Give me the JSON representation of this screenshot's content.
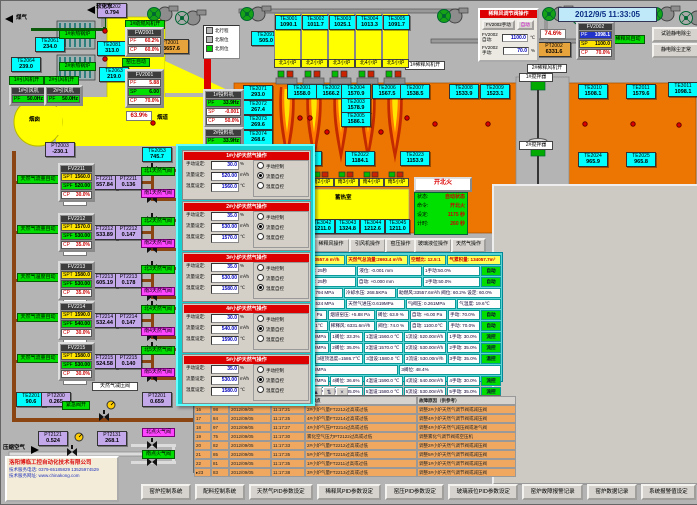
{
  "datetime": "2012/9/5 11:33:05",
  "dilution": {
    "title": "稀释风调节阀操作",
    "manual_btn": "FV2002手动",
    "auto_btn": "自动",
    "auto_label": "FV2002自动:",
    "auto_value": "1100.0",
    "auto_unit": "℃",
    "manual_label": "FV2002手动:",
    "manual_value": "70.0",
    "manual_unit": "%"
  },
  "top_right": {
    "test_btn": "试验静电除尘",
    "ok_btn": "静电除尘正常"
  },
  "fire": {
    "button": "开北火",
    "rows": [
      [
        "状态:",
        "自动状态"
      ],
      [
        "命令:",
        "开北火"
      ],
      [
        "设定:",
        "1175 秒"
      ],
      [
        "计时:",
        "260 秒"
      ]
    ]
  },
  "legend": {
    "items": [
      {
        "sq": "#b8b8b8",
        "t": "北行程"
      },
      {
        "sq": "#b8b8b8",
        "t": "北限位"
      },
      {
        "sq": "#00cc00",
        "t": "北到位"
      }
    ]
  },
  "company": {
    "name": "洛阳博临工控自动化技术有限公司",
    "tel": "技术服务电话: 0379-65185829  13525974529",
    "web": "技术服务网址: www.chinakong.com"
  },
  "regen_north": {
    "room": "蓄热室",
    "cols": [
      [
        "TE3001",
        "1090.1",
        "北1小炉"
      ],
      [
        "TE3002",
        "1011.7",
        "北2小炉"
      ],
      [
        "TE3003",
        "1025.1",
        "北3小炉"
      ],
      [
        "TE3004",
        "1013.3",
        "北4小炉"
      ],
      [
        "TE3005",
        "1091.7",
        "北5小炉"
      ]
    ]
  },
  "regen_south": {
    "room": "蓄热室",
    "cols": [
      [
        "TE3041",
        "1209.6",
        "南1小炉"
      ],
      [
        "TE3042",
        "1211.0",
        "南2小炉"
      ],
      [
        "TE3043",
        "1324.8",
        "南3小炉"
      ],
      [
        "TE3044",
        "1212.6",
        "南4小炉"
      ],
      [
        "TE3045",
        "1211.0",
        "南5小炉"
      ]
    ]
  },
  "op_buttons": [
    {
      "t": "熔化操作",
      "x": 278,
      "w": 30
    },
    {
      "t": "稀释风操作",
      "x": 311,
      "w": 34
    },
    {
      "t": "引风机操作",
      "x": 348,
      "w": 33
    },
    {
      "t": "窑压操作",
      "x": 384,
      "w": 27
    },
    {
      "t": "玻璃液位操作",
      "x": 413,
      "w": 34
    },
    {
      "t": "天然气操作",
      "x": 450,
      "w": 31
    }
  ],
  "controllers": [
    {
      "x": 124,
      "y": 26,
      "w": 33,
      "title": "FW2001",
      "rows": [
        [
          "PF",
          "60.2%",
          "w"
        ],
        [
          "CP",
          "60.0%",
          "r"
        ]
      ]
    },
    {
      "x": 124,
      "y": 68,
      "w": 33,
      "title": "FV2001",
      "rows": [
        [
          "PF",
          "5.88",
          "w"
        ],
        [
          "SP",
          "6.00",
          "g"
        ],
        [
          "CP",
          "70.0%",
          "r"
        ]
      ]
    },
    {
      "x": 202,
      "y": 88,
      "w": 35,
      "title": "1#投料机",
      "rows": [
        [
          "PF",
          "33.9Hz",
          "g"
        ],
        [
          "SP",
          "-0.001",
          "w"
        ],
        [
          "CP",
          "50.0%",
          "r"
        ]
      ]
    },
    {
      "x": 202,
      "y": 126,
      "w": 35,
      "title": "2#投料机",
      "rows": [
        [
          "PF",
          "33.9Hz",
          "g"
        ],
        [
          "SP",
          "-0.001",
          "w"
        ],
        [
          "CP",
          "50.0%",
          "r"
        ]
      ]
    },
    {
      "x": 575,
      "y": 20,
      "w": 33,
      "title": "FV2002",
      "rows": [
        [
          "PF",
          "1098.1",
          "b"
        ],
        [
          "SP",
          "1100.0",
          "y"
        ],
        [
          "CP",
          "70.0%",
          "r"
        ]
      ]
    },
    {
      "x": 8,
      "y": 84,
      "w": 33,
      "title": "1#引风机",
      "rows": [
        [
          "PF",
          "50.0Hz",
          "g"
        ]
      ]
    },
    {
      "x": 43,
      "y": 84,
      "w": 33,
      "title": "2#引风机",
      "rows": [
        [
          "PF",
          "50.0Hz",
          "g"
        ]
      ]
    }
  ],
  "sensors": [
    {
      "id": "PT2202",
      "v": "0.794",
      "x": 96,
      "y": 2,
      "c": "pur"
    },
    {
      "id": "TE2061",
      "v": "234.0",
      "x": 34,
      "y": 36,
      "c": "cyan"
    },
    {
      "id": "TE2064",
      "v": "239.0",
      "x": 10,
      "y": 56,
      "c": "cyan"
    },
    {
      "id": "TE2081",
      "v": "313.0",
      "x": 96,
      "y": 40,
      "c": "cyan"
    },
    {
      "id": "TE2063",
      "v": "219.0",
      "x": 98,
      "y": 66,
      "c": "cyan"
    },
    {
      "id": "PT2003",
      "v": "-230.1",
      "x": 44,
      "y": 141,
      "c": "pur"
    },
    {
      "id": "TE2053",
      "v": "745.7",
      "x": 141,
      "y": 146,
      "c": "cyan"
    },
    {
      "id": "PT2001",
      "v": "33657.6",
      "x": 150,
      "y": 38,
      "c": "org",
      "w": 34
    },
    {
      "id": "PT2002",
      "v": "6331.6",
      "x": 536,
      "y": 41,
      "c": "org",
      "w": 30
    },
    {
      "id": "TE2091",
      "v": "505.0",
      "x": 250,
      "y": 30,
      "c": "cyan"
    },
    {
      "id": "TE2071",
      "v": "293.0",
      "x": 242,
      "y": 84,
      "c": "cyan"
    },
    {
      "id": "TE2072",
      "v": "267.4",
      "x": 242,
      "y": 99,
      "c": "cyan"
    },
    {
      "id": "TE2073",
      "v": "269.6",
      "x": 242,
      "y": 114,
      "c": "cyan"
    },
    {
      "id": "TE2074",
      "v": "268.6",
      "x": 242,
      "y": 129,
      "c": "cyan"
    },
    {
      "id": "TE2075",
      "v": "268.5",
      "x": 242,
      "y": 144,
      "c": "cyan"
    },
    {
      "id": "TE2001",
      "v": "1558.0",
      "x": 286,
      "y": 83,
      "c": "cyan"
    },
    {
      "id": "TE2002",
      "v": "1566.2",
      "x": 315,
      "y": 83,
      "c": "cyan"
    },
    {
      "id": "TE2004",
      "v": "1570.9",
      "x": 340,
      "y": 83,
      "c": "cyan"
    },
    {
      "id": "TE2003",
      "v": "1578.9",
      "x": 340,
      "y": 97,
      "c": "cyan"
    },
    {
      "id": "TE2005",
      "v": "1586.1",
      "x": 340,
      "y": 111,
      "c": "cyan"
    },
    {
      "id": "TE2006",
      "v": "1567.5",
      "x": 371,
      "y": 83,
      "c": "cyan"
    },
    {
      "id": "TE2007",
      "v": "1538.5",
      "x": 399,
      "y": 83,
      "c": "cyan"
    },
    {
      "id": "TE2008",
      "v": "1533.9",
      "x": 448,
      "y": 83,
      "c": "cyan"
    },
    {
      "id": "TE2009",
      "v": "1523.1",
      "x": 479,
      "y": 83,
      "c": "cyan"
    },
    {
      "id": "TE2010",
      "v": "1508.1",
      "x": 577,
      "y": 83,
      "c": "cyan"
    },
    {
      "id": "TE2011",
      "v": "1579.6",
      "x": 625,
      "y": 83,
      "c": "cyan"
    },
    {
      "id": "TE3011",
      "v": "1098.1",
      "x": 667,
      "y": 81,
      "c": "cyan"
    },
    {
      "id": "TE2021",
      "v": "1168.3",
      "x": 291,
      "y": 150,
      "c": "cyan"
    },
    {
      "id": "TE2022",
      "v": "1184.1",
      "x": 344,
      "y": 150,
      "c": "cyan"
    },
    {
      "id": "TE2023",
      "v": "1153.9",
      "x": 399,
      "y": 150,
      "c": "cyan"
    },
    {
      "id": "TE2024",
      "v": "965.9",
      "x": 577,
      "y": 151,
      "c": "cyan"
    },
    {
      "id": "TE2025",
      "v": "965.8",
      "x": 625,
      "y": 151,
      "c": "cyan"
    },
    {
      "id": "TE2201",
      "v": "90.6",
      "x": 15,
      "y": 391,
      "c": "cyan"
    },
    {
      "id": "PT2200",
      "v": "0.265",
      "x": 40,
      "y": 391,
      "c": "pur"
    },
    {
      "id": "PT2201",
      "v": "0.659",
      "x": 141,
      "y": 391,
      "c": "pur"
    },
    {
      "id": "PT2121",
      "v": "0.524",
      "x": 37,
      "y": 430,
      "c": "pur"
    },
    {
      "id": "PT2131",
      "v": "268.1",
      "x": 96,
      "y": 430,
      "c": "pur"
    },
    {
      "id": "PT5001",
      "v": "5.88",
      "x": 495,
      "y": 188,
      "c": "pur"
    },
    {
      "id": "PT5002",
      "v": "6.96",
      "x": 564,
      "y": 188,
      "c": "pur"
    },
    {
      "id": "LT5001",
      "v": "-0.001",
      "x": 625,
      "y": 188,
      "c": "yel"
    }
  ],
  "labels": {
    "green": [
      {
        "t": "1#助燃风机开",
        "x": 124,
        "y": 19,
        "w": 38
      },
      {
        "t": "1#引风机开",
        "x": 8,
        "y": 75,
        "w": 33
      },
      {
        "t": "2#引风机开",
        "x": 43,
        "y": 75,
        "w": 33
      },
      {
        "t": "窑压自动",
        "x": 121,
        "y": 57,
        "w": 26
      },
      {
        "t": "稀释风自动",
        "x": 610,
        "y": 34,
        "w": 32
      },
      {
        "t": "窑压自动",
        "x": 521,
        "y": 190,
        "w": 28
      },
      {
        "t": "玻璃液位自动",
        "x": 652,
        "y": 190,
        "w": 40
      },
      {
        "t": "紧急阀开",
        "x": 61,
        "y": 400,
        "w": 26
      },
      {
        "t": "1#余热锅炉",
        "x": 58,
        "y": 29,
        "w": 35
      },
      {
        "t": "2#余热锅炉",
        "x": 58,
        "y": 61,
        "w": 35
      },
      {
        "t": "南点火气阀",
        "x": 141,
        "y": 449,
        "w": 31
      }
    ],
    "magenta": [
      {
        "t": "北点火气阀",
        "x": 141,
        "y": 427,
        "w": 31
      }
    ],
    "white": [
      {
        "t": "1#稀释风机开",
        "x": 404,
        "y": 60,
        "w": 38
      },
      {
        "t": "2#稀释风机开",
        "x": 526,
        "y": 63,
        "w": 38
      },
      {
        "t": "1#搅拌器",
        "x": 518,
        "y": 72,
        "w": 32
      },
      {
        "t": "2#搅拌器",
        "x": 518,
        "y": 140,
        "w": 32
      },
      {
        "t": "天然气减压阀",
        "x": 91,
        "y": 381,
        "w": 44
      }
    ],
    "red": [
      {
        "t": "助燃风开",
        "x": 203,
        "y": 40,
        "w": 31
      }
    ],
    "pct": [
      {
        "t": "63.9%",
        "x": 125,
        "y": 110,
        "w": 24
      },
      {
        "t": "74.6%",
        "x": 539,
        "y": 28,
        "w": 24
      }
    ],
    "plain": [
      {
        "t": "煤气",
        "x": 15,
        "y": 14
      },
      {
        "t": "软化水",
        "x": 95,
        "y": 3
      },
      {
        "t": "蓄热室",
        "x": 328,
        "y": 41
      },
      {
        "t": "蓄热室",
        "x": 334,
        "y": 194
      },
      {
        "t": "烟道",
        "x": 156,
        "y": 114
      },
      {
        "t": "烟囱",
        "x": 28,
        "y": 116
      },
      {
        "t": "压缩空气",
        "x": 2,
        "y": 444
      }
    ]
  },
  "left_rows": [
    {
      "y": 162,
      "label": "天然气流量自动",
      "fv": "FV2211",
      "spt": "1560.0",
      "spf": "520.00",
      "cp": "30.0%",
      "pct": "33.3%",
      "ft": [
        "FT2211",
        "557.84"
      ],
      "pt": [
        "PT2211",
        "0.136"
      ],
      "north": "北1天然气阀",
      "south": "南1天然气阀"
    },
    {
      "y": 212,
      "label": "天然气流量自动",
      "fv": "FV2212",
      "spt": "1570.0",
      "spf": "530.00",
      "cp": "35.0%",
      "pct": "35.0%",
      "ft": [
        "FT2212",
        "533.89"
      ],
      "pt": [
        "PT2212",
        "0.147"
      ],
      "north": "北2天然气阀",
      "south": "南2天然气阀"
    },
    {
      "y": 260,
      "label": "天然气温度自动",
      "fv": "FV2213",
      "spt": "1580.0",
      "spf": "530.00",
      "cp": "35.0%",
      "pct": "48.4%",
      "ft": [
        "FT2213",
        "605.19"
      ],
      "pt": [
        "PT2213",
        "0.178"
      ],
      "north": "北3天然气阀",
      "south": "南3天然气阀"
    },
    {
      "y": 300,
      "label": "天然气流量自动",
      "fv": "FV2214",
      "spt": "1590.0",
      "spf": "540.00",
      "cp": "30.0%",
      "pct": "36.6%",
      "ft": [
        "FT2214",
        "532.44"
      ],
      "pt": [
        "PT2214",
        "0.147"
      ],
      "north": "北4天然气阀",
      "south": "南4天然气阀"
    },
    {
      "y": 341,
      "label": "天然气流量自动",
      "fv": "FV2215",
      "spt": "1580.0",
      "spf": "530.00",
      "cp": "30.0%",
      "pct": "35.0%",
      "ft": [
        "FT2215",
        "524.58"
      ],
      "pt": [
        "PT2215",
        "0.140"
      ],
      "north": "北5天然气阀",
      "south": "南5天然气阀"
    }
  ],
  "popup": {
    "field_labels": [
      "手动设定:",
      "流量设定:",
      "温度设定:"
    ],
    "units": [
      "%",
      "m³/h",
      "℃"
    ],
    "radio_labels": [
      "手动控制",
      "流量自控",
      "温度自控"
    ],
    "panels": [
      {
        "title": "1#小炉天然气操作",
        "manual": "30.0",
        "flow": "520.00",
        "temp": "1560.0",
        "mode": 1
      },
      {
        "title": "2#小炉天然气操作",
        "manual": "35.0",
        "flow": "530.00",
        "temp": "1570.0",
        "mode": 1
      },
      {
        "title": "3#小炉天然气操作",
        "manual": "35.0",
        "flow": "530.00",
        "temp": "1580.0",
        "mode": 2
      },
      {
        "title": "4#小炉天然气操作",
        "manual": "30.0",
        "flow": "540.00",
        "temp": "1590.0",
        "mode": 1
      },
      {
        "title": "5#小炉天然气操作",
        "manual": "35.0",
        "flow": "530.00",
        "temp": "1580.0",
        "mode": 1
      }
    ]
  },
  "info": {
    "header": [
      "助燃风量:33557.6 m³/h",
      "天然气总流量:2693.4 m³/h",
      "空燃比: 12.5:1",
      "气累积量: 134057.7m³"
    ],
    "rows": [
      [
        "北换火时间: 25秒",
        "液位: -0.001 mm",
        "1手动:50.0%",
        "@自动"
      ],
      [
        "南换火时间: 25秒",
        "自动: +0.000 mm",
        "2手动:50.0%",
        "@自动"
      ],
      [
        "煤气压力:0.794 MPa",
        "冷却水压: 268.5KPa",
        "助燃风:33557.6m³/h 阀位: 60.2% 设定: 60.0%"
      ],
      [
        "空气压力:0.524 MPa",
        "天然气进压:0.619MPa",
        "气阀压: 0.261MPa",
        "气温度: 19.6℃"
      ],
      [
        "窑压: +5.96 Pa",
        "烟道窑压: +5.88 Pa",
        "阀位: 63.9 %",
        "自动: +6.00 Pa",
        "手动: 70.0%",
        "@自动"
      ],
      [
        "窑温: 1098.1℃",
        "稀释风: 6331.6m³/h",
        "阀位: 74.0 %",
        "自动: 1100.0℃",
        "手动: 70.0%",
        "@自动"
      ],
      [
        "1压力:0.638MPa",
        "1阀位: 33.3%",
        "1温设:1560.0 ℃",
        "1流设: 520.00m³/h",
        "1手动: 30.0%",
        "@流控"
      ],
      [
        "2压力:0.542MPa",
        "2阀位: 35.0%",
        "2温设:1570.0 ℃",
        "2流设: 530.00m³/h",
        "2手动: 35.0%",
        "@流控"
      ],
      [
        "1578.8℃",
        "3碹顶温度=1586.7℃",
        "3温设:1580.0 ℃",
        "3流设: 530.00m³/h",
        "3手动: 35.0%",
        "@温控"
      ],
      [
        "3压力:0.178MPa",
        "3阀位: 48.4%"
      ],
      [
        "4压力:0.547MPa",
        "4阀位: 36.6%",
        "4温设:1590.0 ℃",
        "4流设: 540.00m³/h",
        "4手动: 30.0%",
        "@流控"
      ],
      [
        "5压力:0.140MPa",
        "5阀位: 35.0%",
        "5温设:1580.0 ℃",
        "5流设: 530.00m³/h",
        "5手动: 35.0%",
        "@流控"
      ]
    ]
  },
  "alarm": {
    "icons": [
      "▣",
      "☰",
      "?",
      "▤",
      "▤",
      "▤",
      "▤",
      "▦",
      "◑",
      "▲",
      "⇅",
      "×"
    ],
    "headers": [
      "",
      "",
      "",
      "",
      "故障点",
      "故障原因（供参考）"
    ],
    "col_w": [
      13,
      14,
      38,
      30,
      108,
      95
    ],
    "rows": [
      [
        "16",
        "98",
        "2012/09/05",
        "11:17:21",
        "2#小炉气量FT2212过高或过低",
        "调整2#小炉天然气调节阀或减压阀"
      ],
      [
        "17",
        "84",
        "2012/09/05",
        "11:17:25",
        "4#小炉气量FT2214过高或过低",
        "调整4#小炉天然气调节阀或减压阀"
      ],
      [
        "18",
        "97",
        "2012/09/05",
        "11:17:27",
        "4#小炉气压PT2214过高或过低",
        "调整4#小炉天然气减压阀或进气阀"
      ],
      [
        "19",
        "75",
        "2012/09/05",
        "11:17:30",
        "雾化空气压力PT2122过高或过低",
        "调整雾化气调节阀或空压机"
      ],
      [
        "20",
        "82",
        "2012/09/05",
        "11:17:33",
        "2#小炉气量FT2212过高或过低",
        "调整2#小炉天然气调节阀或减压阀"
      ],
      [
        "21",
        "85",
        "2012/09/05",
        "11:17:35",
        "5#小炉气量FT2215过高或过低",
        "调整5#小炉天然气调节阀或减压阀"
      ],
      [
        "22",
        "81",
        "2012/09/05",
        "11:17:35",
        "1#小炉气量FT2211过高或过低",
        "调整1#小炉天然气调节阀或减压阀"
      ],
      [
        "23",
        "83",
        "2012/09/05",
        "11:17:38",
        "3#小炉气量FT2213过高或过低",
        "调整3#小炉天然气调节阀或减压阀"
      ]
    ]
  },
  "trend": {
    "tabs": [
      "窑温趋势",
      "烟道趋势",
      "助燃风趋势",
      "稀释风趋势",
      "窑压趋势",
      "液位趋势",
      "天然气趋势",
      "冷却水趋势"
    ],
    "chart_icons": [
      "«",
      "‹",
      "›",
      "»",
      "+",
      "◎",
      "↔",
      "□"
    ]
  },
  "chart_data": [
    {
      "type": "line",
      "title": "玻璃液位趋势",
      "ylim": [
        -1.35,
        1.35
      ],
      "yticks": [
        "1.000",
        "0.000",
        "-1.000"
      ],
      "ytick_vals": [
        1,
        0,
        -1
      ],
      "xticks": [
        "12/09/04",
        "11:31:56",
        "15:31:56",
        "19:31:56",
        "23:31:56",
        "3:31:56",
        "7:31:56",
        "11:31:56"
      ],
      "series": [
        {
          "name": "玻璃液位 mm",
          "color": "#000000",
          "base": 0.0,
          "amp": 0.01,
          "spikeP": 0,
          "spikeAmp": 0
        }
      ]
    },
    {
      "type": "line",
      "title": "窑压趋势",
      "ylim": [
        -0.3,
        12.2
      ],
      "yticks": [
        "11.00",
        "9.00",
        "6.00",
        "3.00",
        "0.00"
      ],
      "ytick_vals": [
        11,
        9,
        6,
        3,
        0
      ],
      "xticks": [
        "12/09/04",
        "11:31:29",
        "15:31:29",
        "19:31:29",
        "23:31:29",
        "3:31:29",
        "7:31:29",
        "11:31:29"
      ],
      "series": [
        {
          "name": "窑压-黑",
          "color": "#111111",
          "base": 6.7,
          "amp": 0.35,
          "spikeP": 0.42,
          "spikeAmp": -6.2
        },
        {
          "name": "窑压-红",
          "color": "#dd0000",
          "base": 6.9,
          "amp": 0.35,
          "spikeP": 0.38,
          "spikeAmp": 3.3
        }
      ]
    },
    {
      "type": "line",
      "title": "窑温趋势",
      "ylim": [
        1522,
        1600
      ],
      "yticks": [
        "1595.0",
        "1578.0",
        "1561.0",
        "1544.0",
        "1527.0"
      ],
      "ytick_vals": [
        1595,
        1578,
        1561,
        1544,
        1527
      ],
      "xticks": [
        "12/09/04",
        "11:32:51",
        "15:32:51",
        "19:32:51",
        "23:32:51",
        "3:32:51",
        "7:32:51",
        "11:32:51"
      ],
      "series": [
        {
          "name": "窑温-绿",
          "color": "#00bb00",
          "base": 1589,
          "amp": 1.8,
          "spikeP": 0.3,
          "spikeAmp": 3
        },
        {
          "name": "窑温-蓝",
          "color": "#0000dd",
          "base": 1578,
          "amp": 1.5,
          "spikeP": 0.3,
          "spikeAmp": 2.5
        },
        {
          "name": "窑温-红",
          "color": "#dd0000",
          "base": 1570,
          "amp": 1.2,
          "spikeP": 0.25,
          "spikeAmp": 2
        },
        {
          "name": "窑温-黑",
          "color": "#111111",
          "base": 1565,
          "amp": 1.2,
          "spikeP": 0.3,
          "spikeAmp": -2.5
        },
        {
          "name": "窑温-紫",
          "color": "#ee00ee",
          "base": 1539,
          "amp": 1.5,
          "spikeP": 0.3,
          "spikeAmp": -3
        }
      ]
    }
  ],
  "bottom_buttons": [
    "窑炉控制系统",
    "配料控制系统",
    "天然气PID参数设定",
    "稀释风PID参数设定",
    "窑压PID参数设定",
    "玻璃液位PID参数设定",
    "窑炉故障报警记录",
    "窑炉数据记录",
    "系统报警值设定"
  ]
}
